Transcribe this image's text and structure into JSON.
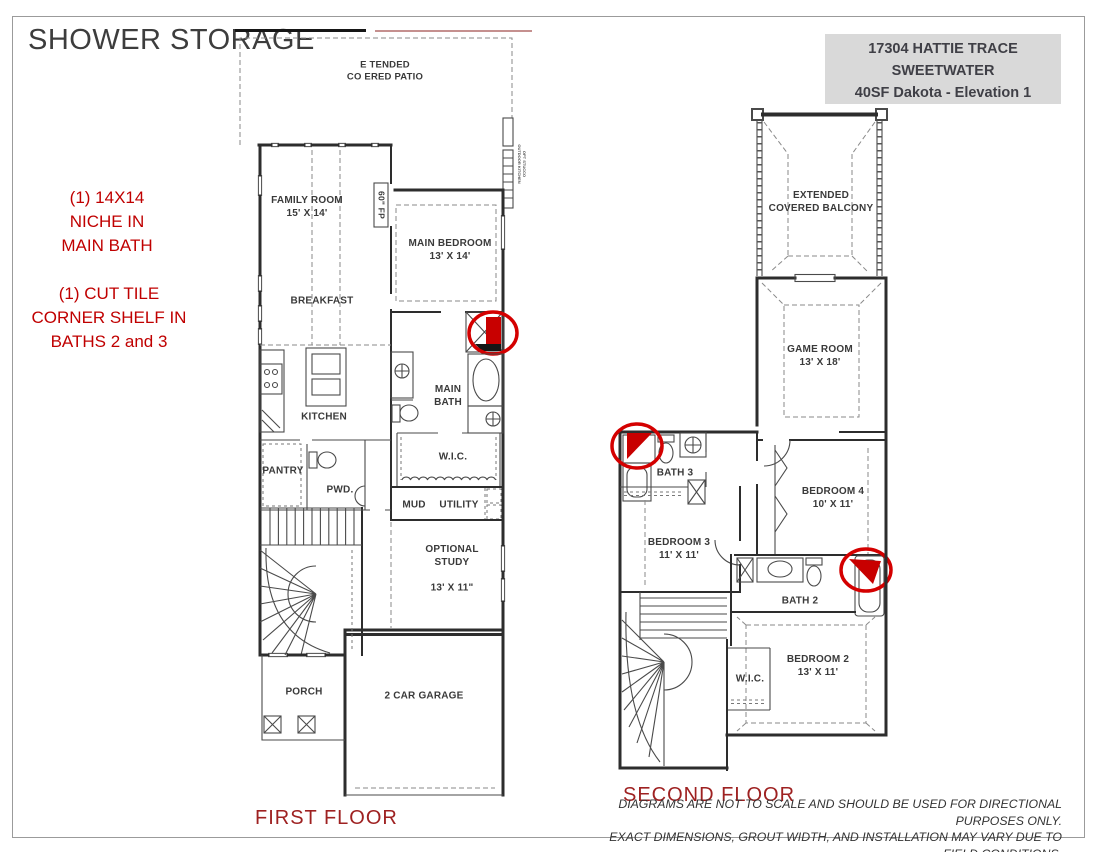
{
  "header": {
    "title": "SHOWER STORAGE",
    "info_box": {
      "line1": "17304 HATTIE TRACE",
      "line2": "SWEETWATER",
      "line3": "40SF Dakota - Elevation 1"
    }
  },
  "annotations": {
    "niche_note": "(1) 14X14\nNICHE IN\nMAIN BATH",
    "corner_shelf_note": "(1) CUT TILE\nCORNER SHELF IN\nBATHS 2 and 3"
  },
  "first_floor": {
    "caption": "FIRST FLOOR",
    "rooms": {
      "patio": "E TENDED\nCO ERED PATIO",
      "family_room": "FAMILY ROOM\n15' X 14'",
      "fireplace": "60\" FP",
      "main_bedroom": "MAIN BEDROOM\n13' X 14'",
      "breakfast": "BREAKFAST",
      "kitchen": "KITCHEN",
      "main_bath": "MAIN\nBATH",
      "wic": "W.I.C.",
      "pantry": "PANTRY",
      "powder": "PWD.",
      "mud": "MUD",
      "utility": "UTILITY",
      "optional_study": "OPTIONAL\nSTUDY",
      "optional_study_dim": "13' X 11\"",
      "porch": "PORCH",
      "garage": "2 CAR GARAGE",
      "outdoor_kitchen_note": "OPT STUCCO\nOUTDOOR KITCHEN"
    }
  },
  "second_floor": {
    "caption": "SECOND FLOOR",
    "rooms": {
      "balcony": "EXTENDED\nCOVERED BALCONY",
      "game_room": "GAME ROOM\n13' X 18'",
      "bath_3": "BATH 3",
      "bedroom_4": "BEDROOM 4\n10' X 11'",
      "bedroom_3": "BEDROOM 3\n11' X 11'",
      "bath_2": "BATH 2",
      "bedroom_2": "BEDROOM 2\n13' X 11'",
      "wic": "W.I.C."
    }
  },
  "footer": {
    "disclaimer": "DIAGRAMS ARE NOT TO SCALE AND SHOULD BE USED FOR DIRECTIONAL PURPOSES ONLY.\nEXACT DIMENSIONS, GROUT WIDTH, AND INSTALLATION MAY VARY DUE TO FIELD CONDITIONS."
  },
  "colors": {
    "annotation_red": "#C00000",
    "caption_red": "#9E2121",
    "marker_red": "#D40000",
    "info_box_bg": "#D9D9D9",
    "title_gray": "#3D3D3D"
  }
}
